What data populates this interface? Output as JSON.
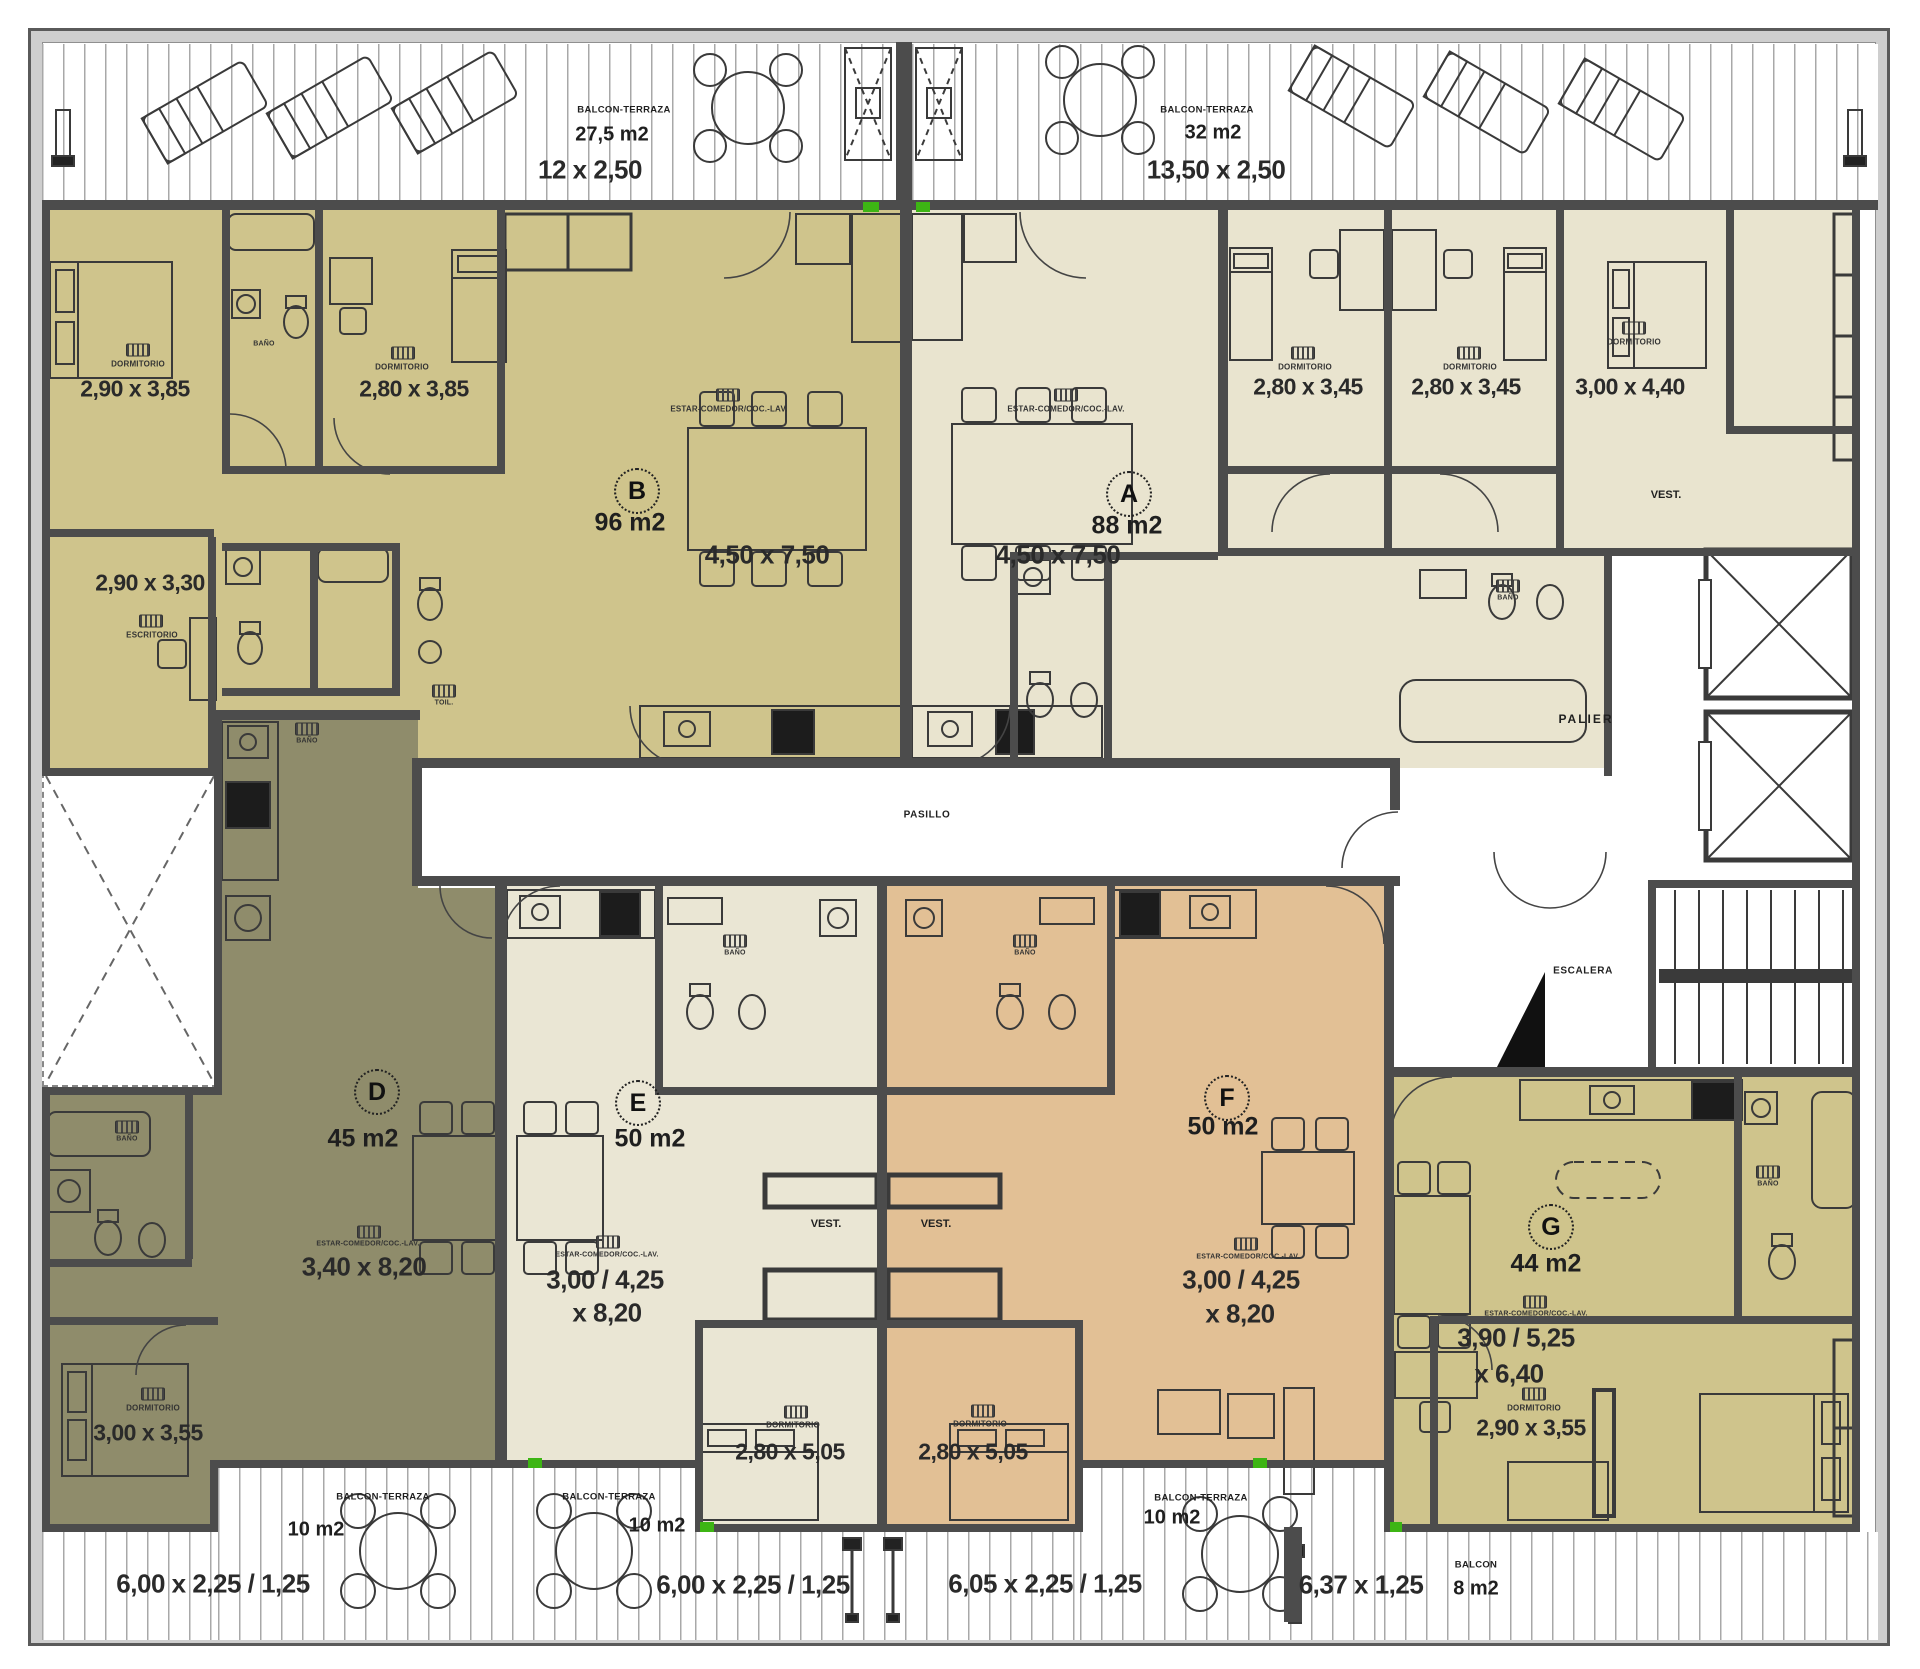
{
  "colors": {
    "unit_a": "#e9e4cf",
    "unit_b": "#cfc48c",
    "unit_d": "#8f8c6b",
    "unit_e": "#eae6d4",
    "unit_f": "#e2c095",
    "unit_g": "#cfc48c",
    "wall": "#4c4c4c",
    "accent_green": "#3db514"
  },
  "top_balcony_left": {
    "name": "BALCON-TERRAZA",
    "area": "27,5 m2",
    "dim": "12 x 2,50"
  },
  "top_balcony_right": {
    "name": "BALCON-TERRAZA",
    "area": "32 m2",
    "dim": "13,50 x 2,50"
  },
  "units": {
    "a": {
      "letter": "A",
      "area": "88 m2",
      "living_name": "ESTAR-COMEDOR/COC.-LAV.",
      "living_dim": "4,50 x 7,50",
      "dorm1_name": "DORMITORIO",
      "dorm1_dim": "2,80 x 3,45",
      "dorm2_name": "DORMITORIO",
      "dorm2_dim": "2,80 x 3,45",
      "dorm3_name": "DORMITORIO",
      "dorm3_dim": "3,00 x 4,40",
      "vest": "VEST.",
      "bano": "BAÑO"
    },
    "b": {
      "letter": "B",
      "area": "96 m2",
      "living_name": "ESTAR-COMEDOR/COC.-LAV.",
      "living_dim": "4,50 x 7,50",
      "dorm1_name": "DORMITORIO",
      "dorm1_dim": "2,90 x 3,85",
      "dorm2_name": "DORMITORIO",
      "dorm2_dim": "2,80 x 3,85",
      "escritorio_name": "ESCRITORIO",
      "escritorio_dim": "2,90 x 3,30",
      "bano": "BAÑO",
      "toil": "TOIL.",
      "bano2": "BAÑO"
    },
    "d": {
      "letter": "D",
      "area": "45 m2",
      "living_name": "ESTAR-COMEDOR/COC.-LAV.",
      "living_dim": "3,40 x 8,20",
      "dorm_name": "DORMITORIO",
      "dorm_dim": "3,00 x 3,55",
      "bano": "BAÑO"
    },
    "e": {
      "letter": "E",
      "area": "50 m2",
      "living_name": "ESTAR-COMEDOR/COC.-LAV.",
      "living_dim1": "3,00 / 4,25",
      "living_dim2": "x 8,20",
      "vest": "VEST.",
      "dorm_name": "DORMITORIO",
      "dorm_dim": "2,80 x 5,05",
      "bano": "BAÑO"
    },
    "f": {
      "letter": "F",
      "area": "50 m2",
      "living_name": "ESTAR-COMEDOR/COC.-LAV.",
      "living_dim1": "3,00 / 4,25",
      "living_dim2": "x 8,20",
      "vest": "VEST.",
      "dorm_name": "DORMITORIO",
      "dorm_dim": "2,80 x 5,05",
      "bano": "BAÑO"
    },
    "g": {
      "letter": "G",
      "area": "44 m2",
      "living_name": "ESTAR-COMEDOR/COC.-LAV.",
      "living_dim1": "3,90 / 5,25",
      "living_dim2": "x 6,40",
      "dorm_name": "DORMITORIO",
      "dorm_dim": "2,90 x 3,55",
      "bano": "BAÑO"
    }
  },
  "common": {
    "pasillo": "PASILLO",
    "palier": "PALIER",
    "escalera": "ESCALERA"
  },
  "bottom_balconies": {
    "left": {
      "name": "BALCON-TERRAZA",
      "area": "10 m2",
      "dim": "6,00 x 2,25 / 1,25"
    },
    "mid": {
      "name": "BALCON-TERRAZA",
      "area": "10 m2",
      "dim": "6,00 x 2,25 / 1,25"
    },
    "right": {
      "name": "BALCON-TERRAZA",
      "area": "10 m2",
      "dim": "6,05 x 2,25 / 1,25"
    },
    "g_dim": "6,37 x 1,25",
    "g_balcon": {
      "name": "BALCON",
      "area": "8 m2"
    }
  }
}
